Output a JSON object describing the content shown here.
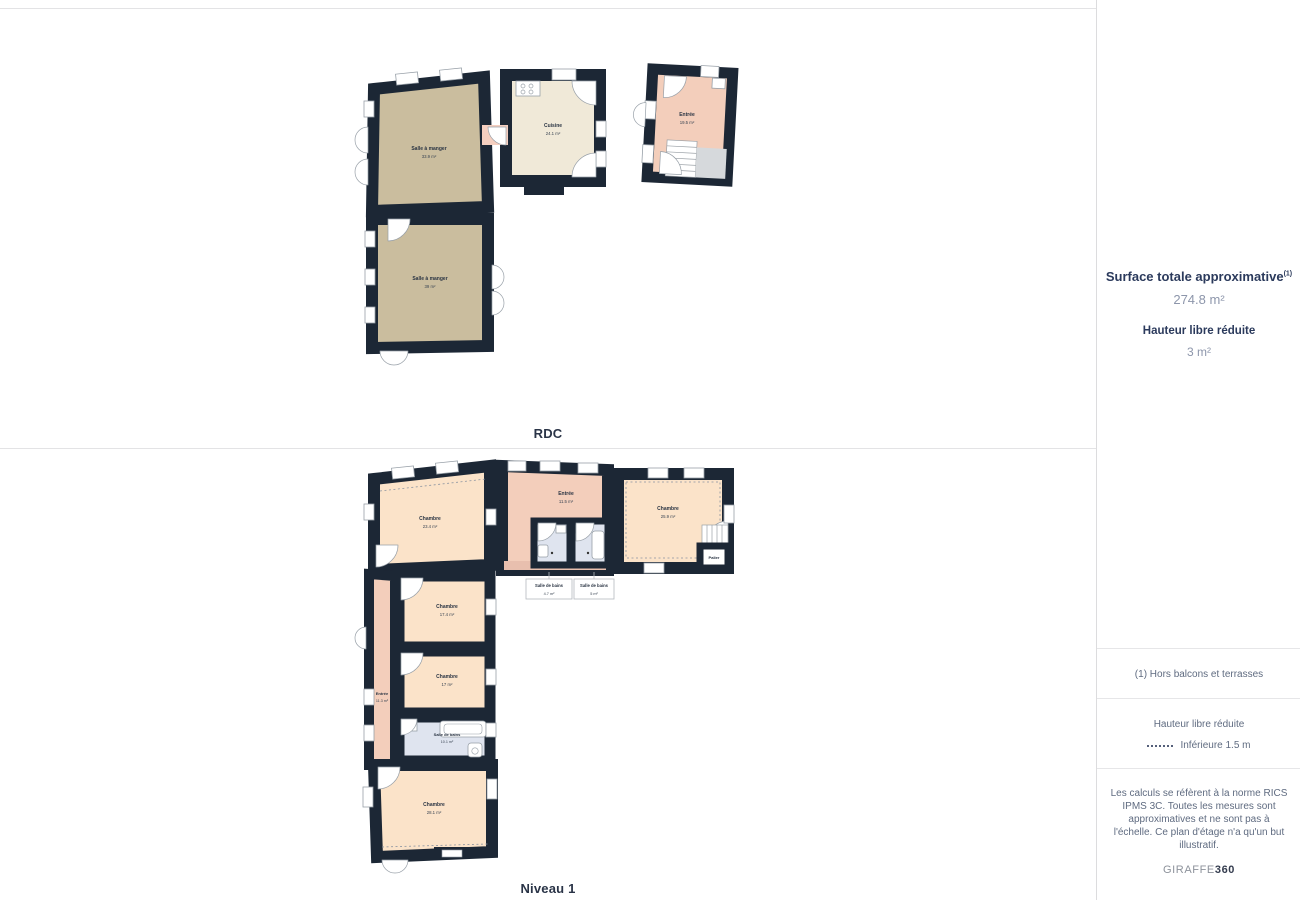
{
  "floors": [
    {
      "label": "RDC",
      "rooms": [
        {
          "name": "Salle à manger",
          "area": "33.9 m²"
        },
        {
          "name": "Cuisine",
          "area": "24.1 m²"
        },
        {
          "name": "Entrée",
          "area": "19.5 m²"
        },
        {
          "name": "Salle à manger",
          "area": "39 m²"
        }
      ]
    },
    {
      "label": "Niveau 1",
      "rooms": [
        {
          "name": "Chambre",
          "area": "23.4 m²"
        },
        {
          "name": "Entrée",
          "area": "11.5 m²"
        },
        {
          "name": "Chambre",
          "area": "25.9 m²"
        },
        {
          "name": "Palier",
          "area": ""
        },
        {
          "name": "Chambre",
          "area": "17.4 m²"
        },
        {
          "name": "Entrée",
          "area": "11.3 m²"
        },
        {
          "name": "Chambre",
          "area": "17 m²"
        },
        {
          "name": "Salle de bains",
          "area": "10.1 m²"
        },
        {
          "name": "Chambre",
          "area": "28.1 m²"
        },
        {
          "name": "Salle de bains",
          "area": "4.7 m²"
        },
        {
          "name": "Salle de bains",
          "area": "5 m²"
        }
      ]
    }
  ],
  "sidebar": {
    "surface_title": "Surface totale approximative",
    "surface_note_ref": "(1)",
    "surface_value": "274.8 m²",
    "height_title": "Hauteur libre réduite",
    "height_value": "3 m²",
    "footnote": "(1) Hors balcons et terrasses",
    "legend_title": "Hauteur libre réduite",
    "legend_label": "Inférieure 1.5 m",
    "disclaimer": "Les calculs se réfèrent à la norme RICS IPMS 3C. Toutes les mesures sont approximatives et ne sont pas à l'échelle. Ce plan d'étage n'a qu'un but illustratif.",
    "brand_name": "GIRAFFE",
    "brand_number": "360"
  },
  "colors": {
    "wall": "#1c2735",
    "dining_tan": "#cabd9e",
    "kitchen_cream": "#f0e9d8",
    "entrance_pink": "#f3cebb",
    "bedroom_peach": "#fbe3c9",
    "bathroom_blue": "#dfe4ef",
    "landing_gray": "#d6d9dc",
    "sidebar_heading": "#2b3a5c",
    "sidebar_value": "#8d96ab"
  }
}
